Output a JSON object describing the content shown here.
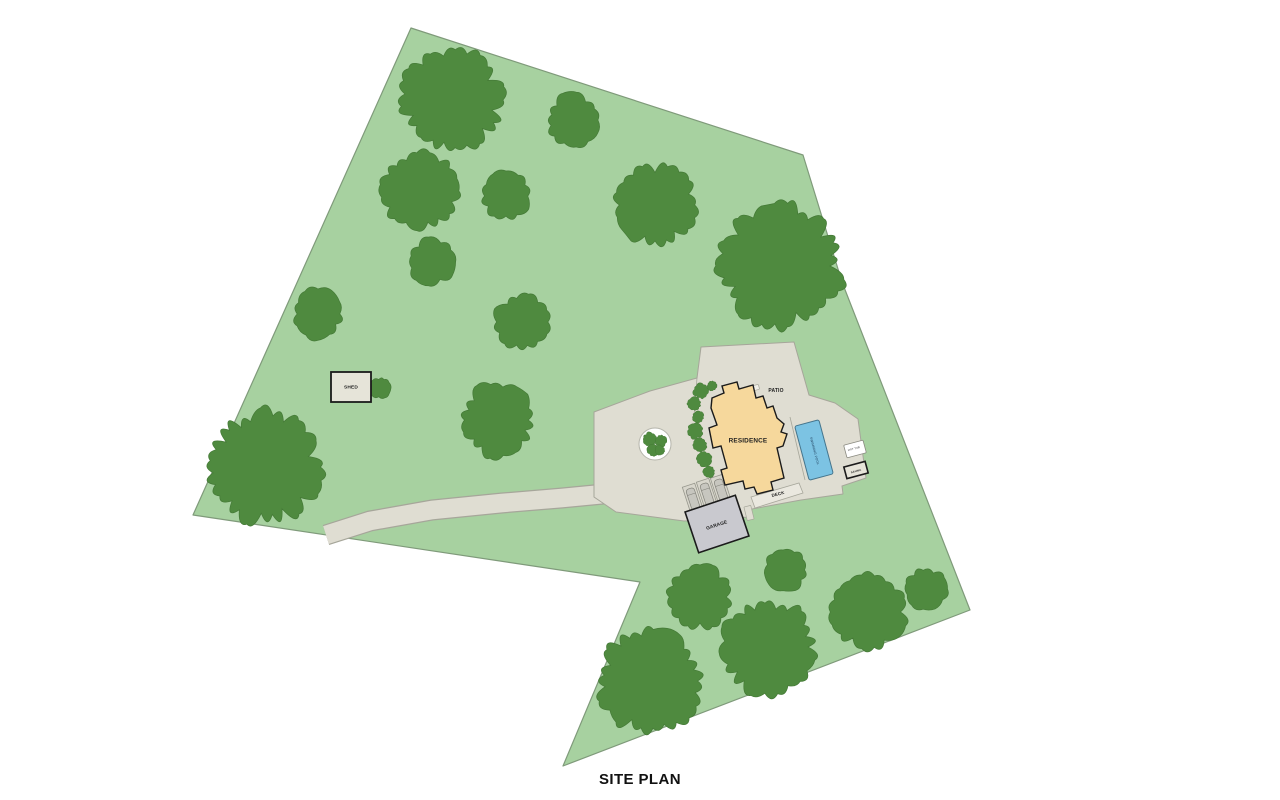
{
  "title": "SITE PLAN",
  "labels": {
    "residence": "RESIDENCE",
    "patio": "PATIO",
    "deck": "DECK",
    "garage": "GARAGE",
    "shed": "SHED",
    "pool": "SWIMMING POOL",
    "hot_tub": "HOT TUB",
    "sauna": "SAUNA"
  },
  "colors": {
    "background": "#ffffff",
    "land": "#a7d1a0",
    "land_border": "#7f9a7a",
    "tree": "#4f8a3f",
    "tree_border": "#447936",
    "paving": "#dfddd2",
    "paving_border": "#a6a69a",
    "paving_light": "#f1efe8",
    "residence_fill": "#f6d89c",
    "outline_dark": "#1b1b1b",
    "garage_fill": "#c9c9cf",
    "shed_fill": "#e6e4d9",
    "deck_fill": "#eae8df",
    "pool_fill": "#7cc3e3",
    "pool_border": "#44748c",
    "pool_text": "#1c3a57",
    "planter_ring": "#ffffff",
    "planter_ring_border": "#b5b5ab",
    "stall_fill": "#d8d6cc",
    "stall_border": "#97978d",
    "car_fill": "#c7c6bf",
    "car_border": "#82827a",
    "label_color": "#1f1f1f"
  },
  "plan": {
    "width": 1280,
    "height": 800,
    "property": [
      [
        411,
        28
      ],
      [
        803,
        155
      ],
      [
        842,
        282
      ],
      [
        970,
        610
      ],
      [
        563,
        766
      ],
      [
        640,
        582
      ],
      [
        193,
        515
      ]
    ],
    "driveway": [
      [
        326,
        535
      ],
      [
        370,
        521
      ],
      [
        432,
        510
      ],
      [
        502,
        503
      ],
      [
        562,
        498
      ],
      [
        614,
        493
      ],
      [
        648,
        489
      ]
    ],
    "hardscape": [
      [
        594,
        412
      ],
      [
        650,
        391
      ],
      [
        697,
        378
      ],
      [
        701,
        347
      ],
      [
        794,
        342
      ],
      [
        809,
        395
      ],
      [
        835,
        403
      ],
      [
        858,
        419
      ],
      [
        866,
        478
      ],
      [
        842,
        486
      ],
      [
        843,
        494
      ],
      [
        801,
        500
      ],
      [
        752,
        509
      ],
      [
        750,
        517
      ],
      [
        684,
        521
      ],
      [
        616,
        512
      ],
      [
        594,
        497
      ]
    ],
    "dividers": [
      [
        [
          697,
          378
        ],
        [
          694,
          416
        ]
      ],
      [
        [
          790,
          417
        ],
        [
          805,
          480
        ]
      ]
    ],
    "deck_poly": [
      [
        751,
        497
      ],
      [
        799,
        483
      ],
      [
        803,
        493
      ],
      [
        755,
        508
      ]
    ],
    "patio_strip": {
      "cx": 743,
      "cy": 391,
      "w": 33,
      "h": 5,
      "rot": -15
    },
    "walkway": {
      "cx": 749,
      "cy": 513,
      "w": 7,
      "h": 14,
      "rot": -14
    },
    "planter": {
      "cx": 655,
      "cy": 444,
      "r": 16,
      "blobs": [
        [
          650,
          439,
          7
        ],
        [
          661,
          441,
          6
        ],
        [
          653,
          450,
          6
        ],
        [
          660,
          450,
          5
        ]
      ]
    },
    "stalls": {
      "w": 13,
      "h": 29,
      "rot": -18,
      "centers": [
        [
          693,
          499
        ],
        [
          707,
          494
        ],
        [
          721,
          490
        ]
      ]
    },
    "trees": [
      [
        452,
        100,
        52
      ],
      [
        573,
        120,
        27
      ],
      [
        420,
        191,
        40
      ],
      [
        506,
        196,
        25
      ],
      [
        655,
        205,
        41
      ],
      [
        432,
        262,
        24
      ],
      [
        781,
        266,
        62
      ],
      [
        318,
        314,
        26
      ],
      [
        522,
        322,
        29
      ],
      [
        497,
        420,
        38
      ],
      [
        264,
        467,
        57
      ],
      [
        380,
        388,
        11
      ],
      [
        700,
        597,
        33
      ],
      [
        786,
        570,
        22
      ],
      [
        768,
        647,
        49
      ],
      [
        650,
        681,
        53
      ],
      [
        868,
        612,
        38
      ],
      [
        926,
        589,
        22
      ]
    ],
    "bushes": [
      [
        701,
        391,
        8
      ],
      [
        694,
        404,
        7
      ],
      [
        698,
        417,
        6
      ],
      [
        695,
        431,
        8
      ],
      [
        700,
        445,
        7
      ],
      [
        704,
        459,
        8
      ],
      [
        709,
        472,
        6
      ],
      [
        712,
        386,
        5
      ]
    ],
    "shed": {
      "x": 331,
      "y": 372,
      "w": 40,
      "h": 30
    },
    "garage": {
      "cx": 717,
      "cy": 524,
      "w": 53,
      "h": 43,
      "rot": -18.5
    },
    "residence": [
      [
        712,
        398
      ],
      [
        724,
        393
      ],
      [
        722,
        386
      ],
      [
        737,
        382
      ],
      [
        739,
        389
      ],
      [
        753,
        385
      ],
      [
        756,
        398
      ],
      [
        763,
        396
      ],
      [
        767,
        408
      ],
      [
        773,
        406
      ],
      [
        777,
        418
      ],
      [
        784,
        424
      ],
      [
        781,
        432
      ],
      [
        787,
        434
      ],
      [
        783,
        446
      ],
      [
        777,
        448
      ],
      [
        784,
        478
      ],
      [
        771,
        482
      ],
      [
        773,
        490
      ],
      [
        757,
        494
      ],
      [
        754,
        487
      ],
      [
        745,
        489
      ],
      [
        743,
        481
      ],
      [
        725,
        485
      ],
      [
        721,
        470
      ],
      [
        727,
        468
      ],
      [
        721,
        446
      ],
      [
        713,
        448
      ],
      [
        709,
        428
      ],
      [
        717,
        425
      ],
      [
        711,
        408
      ]
    ],
    "pool": {
      "cx": 814,
      "cy": 450,
      "w": 25,
      "h": 56,
      "rot": -15
    },
    "hot_tub": {
      "cx": 855,
      "cy": 449,
      "w": 20,
      "h": 13,
      "rot": -15
    },
    "sauna": {
      "cx": 856,
      "cy": 470,
      "w": 22,
      "h": 12,
      "rot": -15
    },
    "text_labels": [
      {
        "key": "shed",
        "x": 351,
        "y": 388,
        "size": 4.8,
        "rot": 0,
        "bold": true
      },
      {
        "key": "patio",
        "x": 776,
        "y": 391,
        "size": 5,
        "rot": 0,
        "bold": true
      },
      {
        "key": "residence",
        "x": 748,
        "y": 441,
        "size": 6.4,
        "rot": 0,
        "bold": true
      },
      {
        "key": "deck",
        "x": 778,
        "y": 494,
        "size": 4.4,
        "rot": -14,
        "bold": true
      },
      {
        "key": "garage",
        "x": 717,
        "y": 526,
        "size": 4.8,
        "rot": -18,
        "bold": true
      },
      {
        "key": "pool",
        "x": 814.5,
        "y": 451,
        "size": 3.2,
        "rot": 75,
        "bold": false,
        "color": "pool_text"
      },
      {
        "key": "hot_tub",
        "x": 854,
        "y": 449,
        "size": 2.6,
        "rot": -15,
        "bold": false
      },
      {
        "key": "sauna",
        "x": 856,
        "y": 471,
        "size": 2.8,
        "rot": -15,
        "bold": true
      }
    ]
  }
}
